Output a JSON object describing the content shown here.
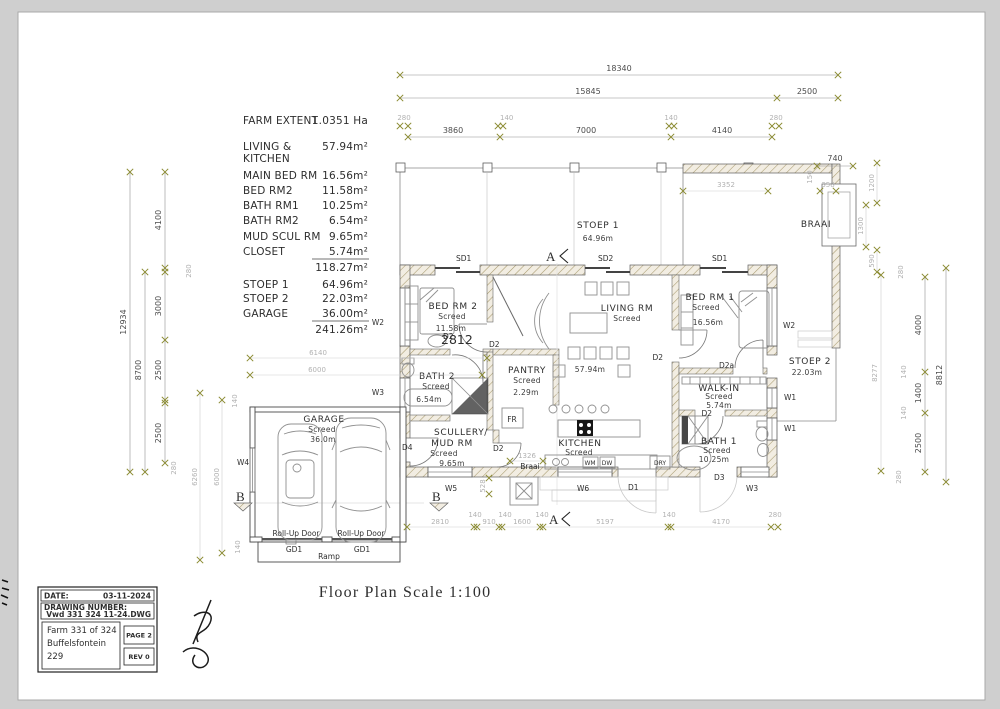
{
  "page": {
    "scale_title": "Floor Plan Scale 1:100"
  },
  "legend": {
    "farm_label": "FARM EXTENT",
    "farm_value": "1.0351 Ha",
    "rows": [
      {
        "l": "LIVING &",
        "v": "57.94m²"
      },
      {
        "l": "KITCHEN",
        "v": ""
      },
      {
        "l": "MAIN BED RM",
        "v": "16.56m²"
      },
      {
        "l": "BED RM2",
        "v": "11.58m²"
      },
      {
        "l": "BATH RM1",
        "v": "10.25m²"
      },
      {
        "l": "BATH RM2",
        "v": "6.54m²"
      },
      {
        "l": "MUD SCUL RM",
        "v": "9.65m²"
      },
      {
        "l": "CLOSET",
        "v": "5.74m²"
      },
      {
        "l": "",
        "v": "118.27m²"
      },
      {
        "l": "STOEP 1",
        "v": "64.96m²"
      },
      {
        "l": "STOEP 2",
        "v": "22.03m²"
      },
      {
        "l": "GARAGE",
        "v": "36.00m²"
      },
      {
        "l": "",
        "v": "241.26m²"
      }
    ]
  },
  "rooms": {
    "stoep1": {
      "name": "STOEP 1",
      "area": "64.96m"
    },
    "braai": {
      "name": "BRAAI"
    },
    "bedrm2": {
      "name": "BED RM 2",
      "finish": "Screed",
      "area": "11.58m"
    },
    "living": {
      "name": "LIVING RM",
      "finish": "Screed",
      "area": "57.94m"
    },
    "bedrm1": {
      "name": "BED RM 1",
      "finish": "Screed",
      "area": "16.56m"
    },
    "bath2": {
      "name": "BATH 2",
      "finish": "Screed",
      "area": "6.54m"
    },
    "pantry": {
      "name": "PANTRY",
      "finish": "Screed",
      "area": "2.29m"
    },
    "scullery": {
      "name1": "SCULLERY/",
      "name2": "MUD RM",
      "finish": "Screed",
      "area": "9.65m"
    },
    "kitchen": {
      "name": "KITCHEN",
      "finish": "Screed"
    },
    "stoep2": {
      "name": "STOEP 2",
      "area": "22.03m"
    },
    "walkin": {
      "name": "WALK-IN",
      "finish": "Screed",
      "area": "5.74m"
    },
    "bath1": {
      "name": "BATH 1",
      "finish": "Screed",
      "area": "10.25m"
    },
    "garage": {
      "name": "GARAGE",
      "finish": "Screed",
      "area": "36.0m"
    }
  },
  "tags": {
    "sd1": "SD1",
    "sd2": "SD2",
    "w1": "W1",
    "w2": "W2",
    "w3": "W3",
    "w4": "W4",
    "w5": "W5",
    "w6": "W6",
    "d1": "D1",
    "d2": "D2",
    "d2a": "D2a",
    "d3": "D3",
    "d4": "D4",
    "gd1": "GD1",
    "fr": "FR",
    "dry": "DRY",
    "wm": "WM",
    "dw": "DW",
    "rollup": "Roll-Up Door",
    "ramp": "Ramp",
    "braai_sm": "Braai"
  },
  "dims": {
    "top": {
      "total": "18340",
      "left": "15845",
      "right": "2500",
      "w1": "280",
      "seg1": "3860",
      "w2": "140",
      "seg2": "7000",
      "w3": "140",
      "seg3": "4140",
      "w4": "280",
      "chimney": "740",
      "braai": "3352",
      "t1": "150",
      "t2": "358"
    },
    "left": {
      "total": "12934",
      "inner": "8700",
      "s1": "4100",
      "s2": "3000",
      "s3": "2500",
      "s4": "2500",
      "w": "280",
      "j": "280",
      "g1": "6260",
      "g2": "6000",
      "f1": "140",
      "f2": "140",
      "h1": "6140",
      "h2": "6000"
    },
    "right": {
      "c1": "1200",
      "c2": "1300",
      "c3": "590",
      "inner": "8277",
      "s1": "4000",
      "s2": "1400",
      "s3": "2500",
      "total": "8812",
      "w1": "280",
      "w2": "280",
      "f1": "140",
      "f2": "140"
    },
    "bottom": {
      "s1": "2810",
      "f1": "140",
      "s2": "910",
      "f2": "140",
      "s3": "1600",
      "f3": "140",
      "s4": "5197",
      "f4": "140",
      "s5": "4170",
      "w": "280",
      "braai": "1326",
      "v": "528"
    },
    "inner": {
      "bed2": "2812"
    }
  },
  "sections": {
    "a": "A",
    "b": "B"
  },
  "titleblock": {
    "date_label": "DATE:",
    "date": "03-11-2024",
    "dwg_label": "DRAWING NUMBER:",
    "dwg": "Vwd 331 324 11-24.DWG",
    "farm1": "Farm 331 of 324",
    "farm2": "Buffelsfontein",
    "farm3": "229",
    "page": "PAGE 2",
    "rev": "REV 0"
  }
}
